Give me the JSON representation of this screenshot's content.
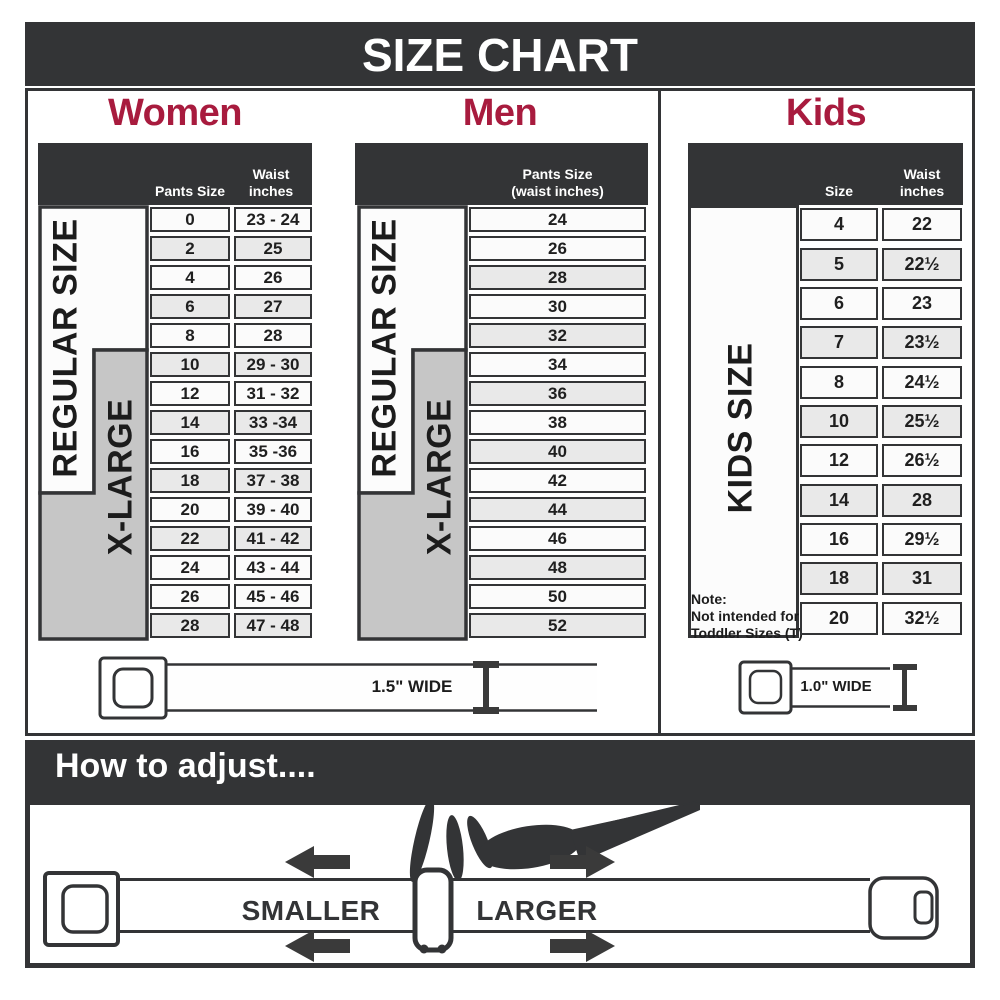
{
  "title": "SIZE CHART",
  "women": {
    "title": "Women",
    "col_size_header": "Pants Size",
    "col_waist_header_line1": "Waist",
    "col_waist_header_line2": "inches",
    "regular_label": "REGULAR SIZE",
    "xlarge_label": "X-LARGE",
    "rows": [
      {
        "size": "0",
        "waist": "23 - 24",
        "shaded": false
      },
      {
        "size": "2",
        "waist": "25",
        "shaded": true
      },
      {
        "size": "4",
        "waist": "26",
        "shaded": false
      },
      {
        "size": "6",
        "waist": "27",
        "shaded": true
      },
      {
        "size": "8",
        "waist": "28",
        "shaded": false
      },
      {
        "size": "10",
        "waist": "29 - 30",
        "shaded": true
      },
      {
        "size": "12",
        "waist": "31 - 32",
        "shaded": false
      },
      {
        "size": "14",
        "waist": "33 -34",
        "shaded": true
      },
      {
        "size": "16",
        "waist": "35 -36",
        "shaded": false
      },
      {
        "size": "18",
        "waist": "37 - 38",
        "shaded": true
      },
      {
        "size": "20",
        "waist": "39 - 40",
        "shaded": false
      },
      {
        "size": "22",
        "waist": "41 - 42",
        "shaded": true
      },
      {
        "size": "24",
        "waist": "43 - 44",
        "shaded": false
      },
      {
        "size": "26",
        "waist": "45 - 46",
        "shaded": false
      },
      {
        "size": "28",
        "waist": "47 - 48",
        "shaded": true
      }
    ]
  },
  "men": {
    "title": "Men",
    "col_header_line1": "Pants Size",
    "col_header_line2": "(waist inches)",
    "regular_label": "REGULAR SIZE",
    "xlarge_label": "X-LARGE",
    "rows": [
      {
        "size": "24",
        "shaded": false
      },
      {
        "size": "26",
        "shaded": false
      },
      {
        "size": "28",
        "shaded": true
      },
      {
        "size": "30",
        "shaded": false
      },
      {
        "size": "32",
        "shaded": true
      },
      {
        "size": "34",
        "shaded": false
      },
      {
        "size": "36",
        "shaded": true
      },
      {
        "size": "38",
        "shaded": false
      },
      {
        "size": "40",
        "shaded": true
      },
      {
        "size": "42",
        "shaded": false
      },
      {
        "size": "44",
        "shaded": true
      },
      {
        "size": "46",
        "shaded": false
      },
      {
        "size": "48",
        "shaded": true
      },
      {
        "size": "50",
        "shaded": false
      },
      {
        "size": "52",
        "shaded": true
      }
    ]
  },
  "kids": {
    "title": "Kids",
    "col_size_header": "Size",
    "col_waist_header_line1": "Waist",
    "col_waist_header_line2": "inches",
    "side_label": "KIDS SIZE",
    "note_line1": "Note:",
    "note_line2": "Not intended for",
    "note_line3": "Toddler Sizes (T)",
    "rows": [
      {
        "size": "4",
        "waist": "22",
        "shaded": false
      },
      {
        "size": "5",
        "waist": "22½",
        "shaded": true
      },
      {
        "size": "6",
        "waist": "23",
        "shaded": false
      },
      {
        "size": "7",
        "waist": "23½",
        "shaded": true
      },
      {
        "size": "8",
        "waist": "24½",
        "shaded": false
      },
      {
        "size": "10",
        "waist": "25½",
        "shaded": true
      },
      {
        "size": "12",
        "waist": "26½",
        "shaded": false
      },
      {
        "size": "14",
        "waist": "28",
        "shaded": true
      },
      {
        "size": "16",
        "waist": "29½",
        "shaded": false
      },
      {
        "size": "18",
        "waist": "31",
        "shaded": true
      },
      {
        "size": "20",
        "waist": "32½",
        "shaded": false
      }
    ]
  },
  "belts": {
    "adult_width_label": "1.5\" WIDE",
    "kids_width_label": "1.0\" WIDE"
  },
  "how_to_adjust": {
    "title": "How to adjust....",
    "smaller_label": "SMALLER",
    "larger_label": "LARGER"
  },
  "colors": {
    "dark": "#333436",
    "accent_red": "#a81b3e",
    "row_shaded": "#e9e9e9",
    "row_plain": "#fbfbfb",
    "xlarge_gray": "#c6c6c6",
    "regular_white": "#fcfcfc"
  }
}
